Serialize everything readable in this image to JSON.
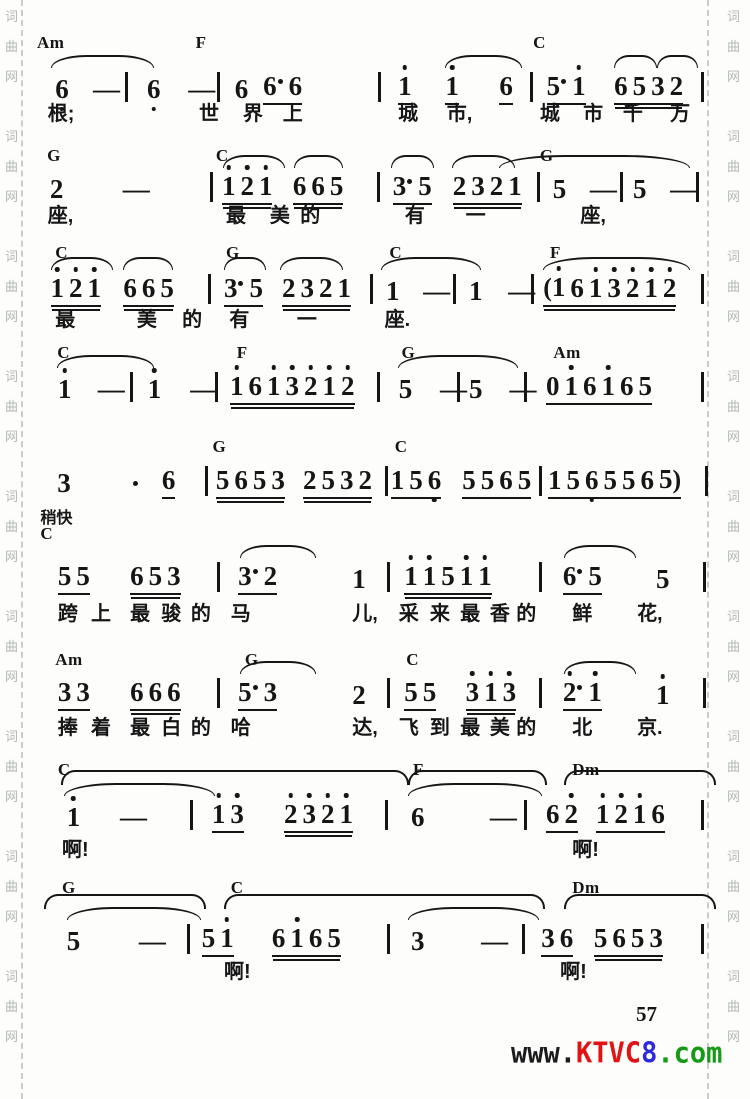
{
  "page": {
    "number": "57",
    "side_watermark_chars": [
      "词",
      "曲",
      "网"
    ],
    "bottom_watermark": [
      {
        "text": "www.",
        "color": "#1c1c1c"
      },
      {
        "text": "KTVC",
        "color": "#e11414"
      },
      {
        "text": "8",
        "color": "#2b2bdd"
      },
      {
        "text": ".com",
        "color": "#159a15"
      }
    ],
    "ink_color": "#161616",
    "paper_color": "#fdfdfc"
  },
  "score": {
    "tempo_mark": "稍快",
    "rows": [
      {
        "yc": 33,
        "yn": 70,
        "yl": 104,
        "chords": [
          {
            "x": 0,
            "l": "Am"
          },
          {
            "x": 23.5,
            "l": "F"
          },
          {
            "x": 73.5,
            "l": "C"
          }
        ],
        "slurs": [
          {
            "x": 2,
            "w": 15
          },
          {
            "x": 60.5,
            "w": 11
          },
          {
            "x": 85.5,
            "w": 6
          },
          {
            "x": 91.8,
            "w": 5.8
          }
        ],
        "notes": [
          {
            "x": 2.7,
            "t": "6,"
          },
          {
            "x": 8.3,
            "t": "-"
          },
          {
            "x": 13,
            "t": "|"
          },
          {
            "x": 16.3,
            "t": "6,"
          },
          {
            "x": 22.4,
            "t": "-"
          },
          {
            "x": 26.7,
            "t": "|"
          },
          {
            "x": 29.3,
            "t": "6"
          },
          {
            "x": 33.5,
            "t": "6· 6",
            "u": 1
          },
          {
            "x": 50.5,
            "t": "|"
          },
          {
            "x": 53.5,
            "t": "1'",
            "u": 1
          },
          {
            "x": 60.5,
            "t": "1'",
            "u": 1
          },
          {
            "x": 68.5,
            "t": "6",
            "u": 1
          },
          {
            "x": 73,
            "t": "|"
          },
          {
            "x": 75.5,
            "t": "5· 1'",
            "u": 1
          },
          {
            "x": 85.5,
            "t": "6 5 3 2",
            "u": 2
          },
          {
            "x": 98.3,
            "t": "|"
          }
        ],
        "lyrics": [
          {
            "x": 1.6,
            "t": "根;"
          },
          {
            "x": 24,
            "t": "世"
          },
          {
            "x": 30.5,
            "t": "界"
          },
          {
            "x": 36.4,
            "t": "上"
          },
          {
            "x": 53.5,
            "t": "城"
          },
          {
            "x": 60.7,
            "t": "市,"
          },
          {
            "x": 74.5,
            "t": "城"
          },
          {
            "x": 80.9,
            "t": "市"
          },
          {
            "x": 86.8,
            "t": "千"
          },
          {
            "x": 93.8,
            "t": "万"
          }
        ]
      },
      {
        "yc": 146,
        "yn": 170,
        "yl": 206,
        "chords": [
          {
            "x": 1.5,
            "l": "G"
          },
          {
            "x": 26.5,
            "l": "C"
          },
          {
            "x": 74.5,
            "l": "G"
          }
        ],
        "slurs": [
          {
            "x": 27.5,
            "w": 9
          },
          {
            "x": 38,
            "w": 7
          },
          {
            "x": 52.5,
            "w": 6
          },
          {
            "x": 61.5,
            "w": 9
          },
          {
            "x": 68.5,
            "w": 28
          }
        ],
        "notes": [
          {
            "x": 1.9,
            "t": "2"
          },
          {
            "x": 12.7,
            "t": "-"
          },
          {
            "x": 25.6,
            "t": "|"
          },
          {
            "x": 27.4,
            "t": "1' 2' 1'",
            "u": 2
          },
          {
            "x": 37.9,
            "t": "6 6 5",
            "u": 2
          },
          {
            "x": 50.4,
            "t": "|"
          },
          {
            "x": 52.7,
            "t": "3· 5",
            "u": 1
          },
          {
            "x": 61.6,
            "t": "2 3 2 1",
            "u": 2
          },
          {
            "x": 74,
            "t": "|"
          },
          {
            "x": 76.4,
            "t": "5"
          },
          {
            "x": 81.9,
            "t": "-"
          },
          {
            "x": 86.4,
            "t": "|"
          },
          {
            "x": 88.3,
            "t": "5"
          },
          {
            "x": 93.8,
            "t": "-"
          },
          {
            "x": 97.6,
            "t": "|"
          }
        ],
        "lyrics": [
          {
            "x": 1.6,
            "t": "座,"
          },
          {
            "x": 28,
            "t": "最"
          },
          {
            "x": 34.5,
            "t": "美"
          },
          {
            "x": 39,
            "t": "的"
          },
          {
            "x": 54.5,
            "t": "有"
          },
          {
            "x": 63.5,
            "t": "一"
          },
          {
            "x": 80.5,
            "t": "座,"
          }
        ]
      },
      {
        "yc": 243,
        "yn": 272,
        "yl": 310,
        "chords": [
          {
            "x": 2.7,
            "l": "C"
          },
          {
            "x": 28,
            "l": "G"
          },
          {
            "x": 52.2,
            "l": "C"
          },
          {
            "x": 76,
            "l": "F"
          }
        ],
        "slurs": [
          {
            "x": 2,
            "w": 9
          },
          {
            "x": 12.8,
            "w": 7
          },
          {
            "x": 27.7,
            "w": 6
          },
          {
            "x": 36,
            "w": 9
          },
          {
            "x": 51,
            "w": 14.5
          },
          {
            "x": 75,
            "w": 21.5
          }
        ],
        "notes": [
          {
            "x": 2,
            "t": "1' 2' 1'",
            "u": 2
          },
          {
            "x": 12.8,
            "t": "6 6 5",
            "u": 2
          },
          {
            "x": 25.4,
            "t": "|"
          },
          {
            "x": 27.7,
            "t": "3· 5",
            "u": 1
          },
          {
            "x": 36.3,
            "t": "2 3 2 1",
            "u": 2
          },
          {
            "x": 49.3,
            "t": "|"
          },
          {
            "x": 51.7,
            "t": "1"
          },
          {
            "x": 57.2,
            "t": "-"
          },
          {
            "x": 61.7,
            "t": "|"
          },
          {
            "x": 64,
            "t": "1"
          },
          {
            "x": 69.8,
            "t": "-"
          },
          {
            "x": 73.2,
            "t": "|"
          },
          {
            "x": 75,
            "t": "(1' 6 1' 3' 2' 1' 2'",
            "u": 2
          },
          {
            "x": 98.3,
            "t": "|"
          }
        ],
        "lyrics": [
          {
            "x": 2.7,
            "t": "最"
          },
          {
            "x": 14.8,
            "t": "美"
          },
          {
            "x": 21.5,
            "t": "的"
          },
          {
            "x": 28.5,
            "t": "有"
          },
          {
            "x": 38.5,
            "t": "一"
          },
          {
            "x": 51.5,
            "t": "座."
          }
        ]
      },
      {
        "yc": 343,
        "yn": 370,
        "yl": 0,
        "chords": [
          {
            "x": 3,
            "l": "C"
          },
          {
            "x": 29.6,
            "l": "F"
          },
          {
            "x": 54,
            "l": "G"
          },
          {
            "x": 76.5,
            "l": "Am"
          }
        ],
        "slurs": [
          {
            "x": 3,
            "w": 14
          },
          {
            "x": 53.5,
            "w": 17.5
          }
        ],
        "notes": [
          {
            "x": 3.1,
            "t": "1'"
          },
          {
            "x": 9,
            "t": "-"
          },
          {
            "x": 13.8,
            "t": "|"
          },
          {
            "x": 16.4,
            "t": "1'"
          },
          {
            "x": 22.7,
            "t": "-"
          },
          {
            "x": 26.4,
            "t": "|"
          },
          {
            "x": 28.6,
            "t": "1' 6 1' 3' 2' 1' 2'",
            "u": 2
          },
          {
            "x": 50.4,
            "t": "|"
          },
          {
            "x": 53.6,
            "t": "5"
          },
          {
            "x": 59.7,
            "t": "-"
          },
          {
            "x": 62.2,
            "t": "|"
          },
          {
            "x": 64,
            "t": "5"
          },
          {
            "x": 70,
            "t": "-"
          },
          {
            "x": 72.2,
            "t": "|"
          },
          {
            "x": 75.4,
            "t": "0 1' 6 1' 6 5",
            "u": 1
          },
          {
            "x": 98.3,
            "t": "|"
          }
        ],
        "lyrics": []
      },
      {
        "yc": 437,
        "yn": 464,
        "yl": 0,
        "chords": [
          {
            "x": 26,
            "l": "G"
          },
          {
            "x": 53,
            "l": "C"
          }
        ],
        "slurs": [],
        "notes": [
          {
            "x": 3,
            "t": "3"
          },
          {
            "x": 14,
            "t": "·"
          },
          {
            "x": 18.5,
            "t": "6",
            "u": 1
          },
          {
            "x": 24.9,
            "t": "|"
          },
          {
            "x": 26.5,
            "t": "5 6 5 3",
            "u": 2
          },
          {
            "x": 39.4,
            "t": "2 5 3 2",
            "u": 2
          },
          {
            "x": 51.5,
            "t": "|"
          },
          {
            "x": 52.4,
            "t": "1 5 6,",
            "u": 1
          },
          {
            "x": 63,
            "t": "5 5 6 5",
            "u": 1
          },
          {
            "x": 74.4,
            "t": "|"
          },
          {
            "x": 75.7,
            "t": "1 5 6, 5 5 6 5)",
            "u": 1
          },
          {
            "x": 99,
            "t": "|"
          }
        ],
        "lyrics": []
      },
      {
        "tempo": "稍快",
        "yc": 524,
        "yn": 560,
        "yl": 604,
        "chords": [
          {
            "x": 0.5,
            "l": "C"
          }
        ],
        "slurs": [
          {
            "x": 30,
            "w": 11
          },
          {
            "x": 78,
            "w": 10.5
          }
        ],
        "notes": [
          {
            "x": 3.1,
            "t": "5 5",
            "u": 1
          },
          {
            "x": 13.8,
            "t": "6 5 3",
            "u": 2
          },
          {
            "x": 26.7,
            "t": "|"
          },
          {
            "x": 29.8,
            "t": "3· 2",
            "u": 1
          },
          {
            "x": 46.7,
            "t": "1"
          },
          {
            "x": 51.9,
            "t": "|"
          },
          {
            "x": 54.4,
            "t": "1' 1' 5 1' 1'",
            "u": 2
          },
          {
            "x": 74.4,
            "t": "|"
          },
          {
            "x": 77.9,
            "t": "6· 5",
            "u": 1
          },
          {
            "x": 91.7,
            "t": "5"
          },
          {
            "x": 98.7,
            "t": "|"
          }
        ],
        "lyrics": [
          {
            "x": 3.1,
            "t": "跨"
          },
          {
            "x": 8,
            "t": "上"
          },
          {
            "x": 13.8,
            "t": "最"
          },
          {
            "x": 18.4,
            "t": "骏"
          },
          {
            "x": 22.8,
            "t": "的"
          },
          {
            "x": 28.7,
            "t": "马"
          },
          {
            "x": 46.7,
            "t": "儿,"
          },
          {
            "x": 53.6,
            "t": "采"
          },
          {
            "x": 58.2,
            "t": "来"
          },
          {
            "x": 62.7,
            "t": "最"
          },
          {
            "x": 67.1,
            "t": "香"
          },
          {
            "x": 71,
            "t": "的"
          },
          {
            "x": 79.3,
            "t": "鲜"
          },
          {
            "x": 88.9,
            "t": "花,"
          }
        ]
      },
      {
        "yc": 650,
        "yn": 676,
        "yl": 718,
        "chords": [
          {
            "x": 2.7,
            "l": "Am"
          },
          {
            "x": 30.8,
            "l": "G"
          },
          {
            "x": 54.7,
            "l": "C"
          }
        ],
        "slurs": [
          {
            "x": 30,
            "w": 11
          },
          {
            "x": 78,
            "w": 10.5
          }
        ],
        "notes": [
          {
            "x": 3.1,
            "t": "3 3",
            "u": 1
          },
          {
            "x": 13.8,
            "t": "6 6 6",
            "u": 2
          },
          {
            "x": 26.7,
            "t": "|"
          },
          {
            "x": 29.8,
            "t": "5· 3",
            "u": 1
          },
          {
            "x": 46.7,
            "t": "2"
          },
          {
            "x": 51.9,
            "t": "|"
          },
          {
            "x": 54.4,
            "t": "5 5",
            "u": 1
          },
          {
            "x": 63.5,
            "t": "3' 1' 3'",
            "u": 2
          },
          {
            "x": 74.4,
            "t": "|"
          },
          {
            "x": 77.9,
            "t": "2'· 1'",
            "u": 1
          },
          {
            "x": 91.7,
            "t": "1'"
          },
          {
            "x": 98.7,
            "t": "|"
          }
        ],
        "lyrics": [
          {
            "x": 3.1,
            "t": "捧"
          },
          {
            "x": 8,
            "t": "着"
          },
          {
            "x": 13.8,
            "t": "最"
          },
          {
            "x": 18.4,
            "t": "白"
          },
          {
            "x": 22.8,
            "t": "的"
          },
          {
            "x": 28.7,
            "t": "哈"
          },
          {
            "x": 46.7,
            "t": "达,"
          },
          {
            "x": 53.6,
            "t": "飞"
          },
          {
            "x": 58.2,
            "t": "到"
          },
          {
            "x": 62.7,
            "t": "最"
          },
          {
            "x": 67.1,
            "t": "美"
          },
          {
            "x": 71,
            "t": "的"
          },
          {
            "x": 79.3,
            "t": "北"
          },
          {
            "x": 88.9,
            "t": "京."
          }
        ]
      },
      {
        "yc": 760,
        "yn": 798,
        "yl": 840,
        "chords": [
          {
            "x": 3.1,
            "l": "C"
          },
          {
            "x": 55.7,
            "l": "F"
          },
          {
            "x": 79.3,
            "l": "Dm"
          }
        ],
        "slurs": [
          {
            "x": 3.5,
            "w": 51,
            "tier": 2
          },
          {
            "x": 55,
            "w": 20,
            "tier": 2
          },
          {
            "x": 78,
            "w": 22,
            "tier": 2
          },
          {
            "x": 4,
            "w": 22
          },
          {
            "x": 55,
            "w": 19.5
          }
        ],
        "notes": [
          {
            "x": 4.4,
            "t": "1'"
          },
          {
            "x": 12.3,
            "t": "-"
          },
          {
            "x": 22.7,
            "t": "|"
          },
          {
            "x": 25.9,
            "t": "1' 3'",
            "u": 1
          },
          {
            "x": 36.6,
            "t": "2' 3' 2' 1'",
            "u": 2
          },
          {
            "x": 51.5,
            "t": "|"
          },
          {
            "x": 55.4,
            "t": "6"
          },
          {
            "x": 67.1,
            "t": "-"
          },
          {
            "x": 72.2,
            "t": "|"
          },
          {
            "x": 75.4,
            "t": "6 2'",
            "u": 1
          },
          {
            "x": 82.8,
            "t": "1' 2' 1' 6",
            "u": 1
          },
          {
            "x": 98.3,
            "t": "|"
          }
        ],
        "lyrics": [
          {
            "x": 3.7,
            "t": "啊!"
          },
          {
            "x": 79.3,
            "t": "啊!"
          }
        ]
      },
      {
        "yc": 878,
        "yn": 922,
        "yl": 962,
        "chords": [
          {
            "x": 3.7,
            "l": "G"
          },
          {
            "x": 28.7,
            "l": "C"
          },
          {
            "x": 79.3,
            "l": "Dm"
          }
        ],
        "slurs": [
          {
            "x": 1,
            "w": 23.5,
            "tier": 2
          },
          {
            "x": 27.7,
            "w": 47,
            "tier": 2
          },
          {
            "x": 78,
            "w": 22,
            "tier": 2
          },
          {
            "x": 4.5,
            "w": 19.5
          },
          {
            "x": 55,
            "w": 19
          }
        ],
        "notes": [
          {
            "x": 4.4,
            "t": "5"
          },
          {
            "x": 15.1,
            "t": "-"
          },
          {
            "x": 22.2,
            "t": "|"
          },
          {
            "x": 24.4,
            "t": "5 1'",
            "u": 1
          },
          {
            "x": 34.8,
            "t": "6 1' 6 5",
            "u": 2
          },
          {
            "x": 51.9,
            "t": "|"
          },
          {
            "x": 55.4,
            "t": "3"
          },
          {
            "x": 65.8,
            "t": "-"
          },
          {
            "x": 71.9,
            "t": "|"
          },
          {
            "x": 74.7,
            "t": "3 6",
            "u": 1
          },
          {
            "x": 82.5,
            "t": "5 6 5 3",
            "u": 2
          },
          {
            "x": 98.3,
            "t": "|"
          }
        ],
        "lyrics": [
          {
            "x": 27.7,
            "t": "啊!"
          },
          {
            "x": 77.5,
            "t": "啊!"
          }
        ]
      }
    ]
  }
}
